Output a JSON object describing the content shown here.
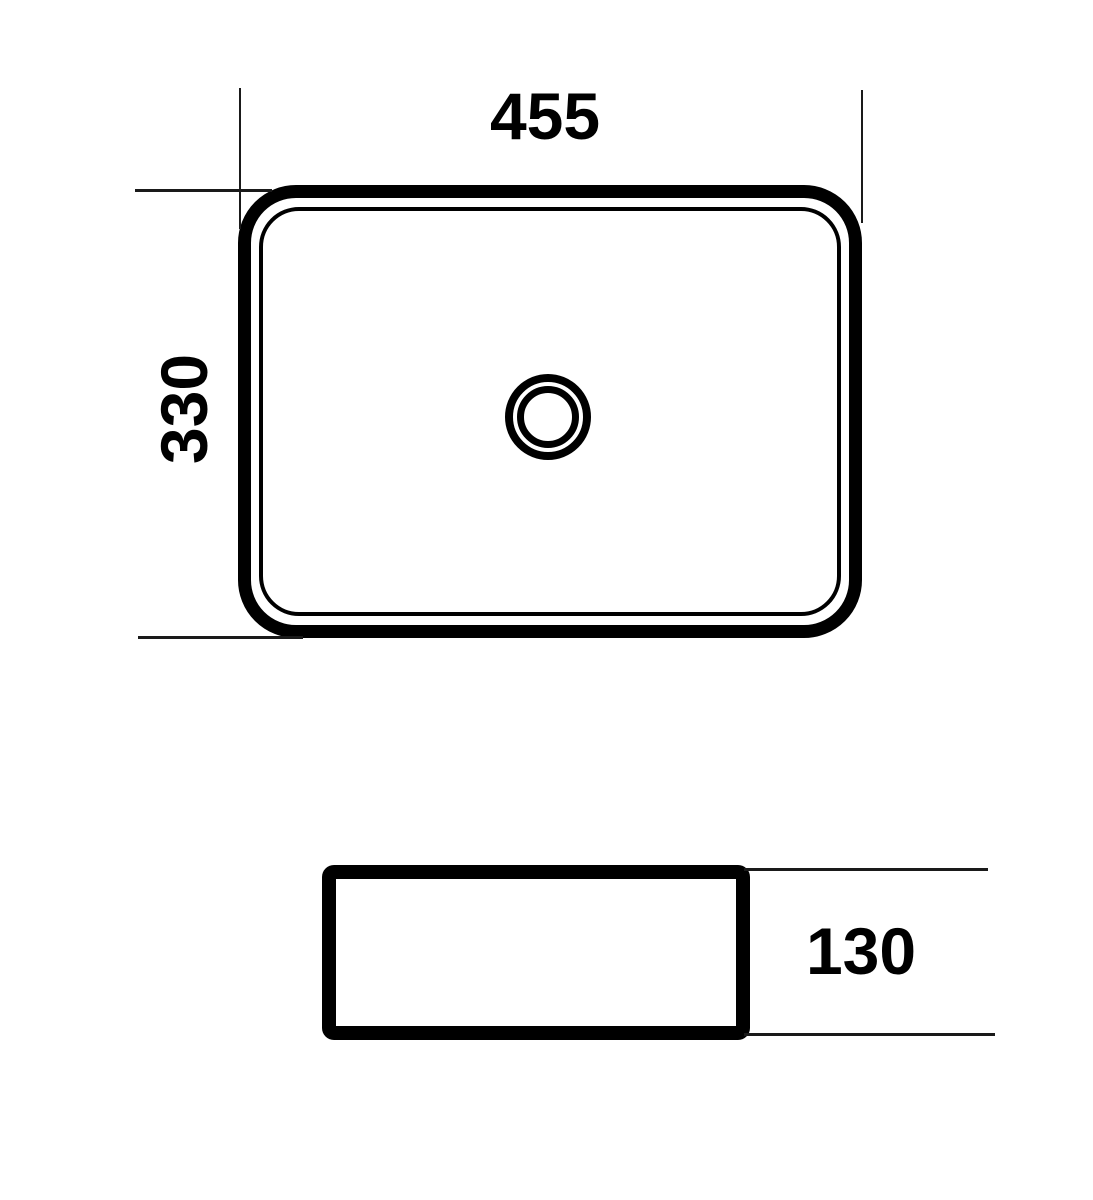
{
  "drawing": {
    "kind": "washbasin-dimension-drawing",
    "colors": {
      "line": "#000000",
      "thin_line": "#1a1a1a",
      "background": "#ffffff"
    },
    "views": {
      "top": {
        "width_label": "455",
        "depth_label": "330",
        "drain_icon": "drain-circle"
      },
      "side": {
        "height_label": "130"
      }
    }
  }
}
